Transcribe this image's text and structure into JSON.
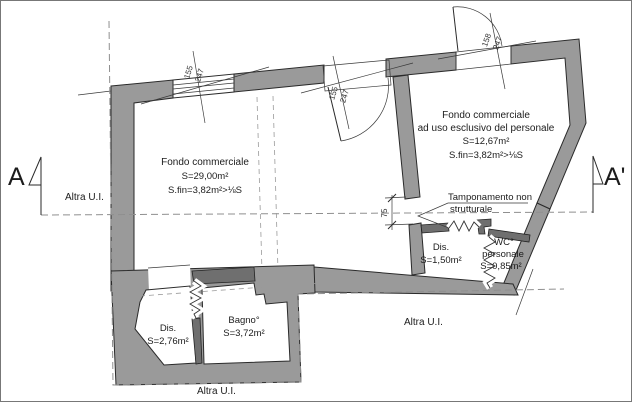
{
  "section": {
    "left": "A",
    "right": "A'"
  },
  "boundary_label": "Altra U.I.",
  "rooms": [
    {
      "name": "Fondo commerciale",
      "area": "S=29,00m²",
      "sfin": "S.fin=3,82m²>⅛S"
    },
    {
      "name": "Fondo commerciale",
      "subtitle": "ad uso esclusivo del personale",
      "area": "S=12,67m²",
      "sfin": "S.fin=3,82m²>⅛S"
    },
    {
      "name": "Dis.",
      "area": "S=1,50m²"
    },
    {
      "name": "WC°",
      "subtitle": "personale",
      "area": "S=0,85m²"
    },
    {
      "name": "Dis.",
      "area": "S=2,76m²"
    },
    {
      "name": "Bagno°",
      "area": "S=3,72m²"
    }
  ],
  "annotation": {
    "line1": "Tamponamento non",
    "line2": "strutturale"
  },
  "dimensions": {
    "window_main": {
      "width": "155",
      "height": "247"
    },
    "door_main": {
      "width": "155",
      "height": "247"
    },
    "door_staff": {
      "width": "158",
      "height": "247"
    },
    "wall_gap": "75"
  },
  "colors": {
    "wall_fill": "#9a9a9a",
    "wall_dark": "#6f6f6f",
    "line": "#2a2a2a",
    "dashed": "#8f8f8f",
    "background": "#ffffff"
  }
}
